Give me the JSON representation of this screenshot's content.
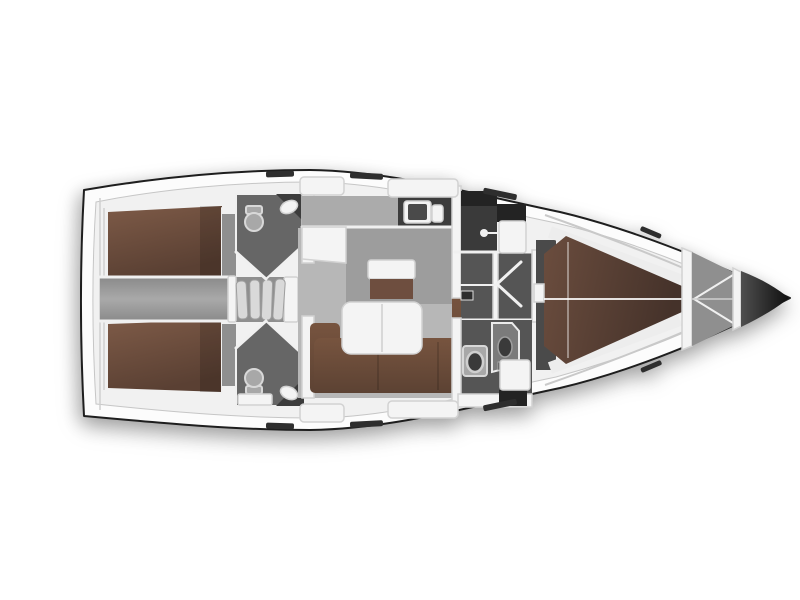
{
  "figure": {
    "kind": "sailing-yacht-interior-floor-plan",
    "view": "top-down, bow pointing right",
    "visible_text": []
  },
  "palette": {
    "page_bg": "#ffffff",
    "hull_line": "#1e1e1e",
    "hull_fill": "#fcfcfc",
    "deck_fill": "#f1f1f1",
    "deck_stroke": "#c6c6c6",
    "rim_line": "#cfcfcf",
    "floor_salon": "#b7b7b7",
    "floor_salon_dark": "#9d9d9d",
    "floor_cabin": "#8f8f8f",
    "corr_edge": "#8a8a8a",
    "corr_mid": "#a9a9a9",
    "floor_dark": "#4a4a4a",
    "wet_floor": "#555555",
    "wet_dark": "#3a3a3a",
    "wet_darkest": "#232323",
    "head_floor": "#666666",
    "counter_dark": "#3c3c3c",
    "counter_shadow": "#ababab",
    "bed_light": "#7d5a47",
    "bed_dark": "#5a4033",
    "fwd_bed_light": "#6b4d3e",
    "fwd_bed_dark": "#45322a",
    "sofa_light": "#77543f",
    "sofa_dark": "#5c4233",
    "wood_small": "#6e4e3f",
    "furn_white": "#f4f4f4",
    "furn_stroke": "#d2d2d2",
    "trim_white": "#f0f0f0",
    "step_fill": "#d9d9d9",
    "step_stroke": "#9e9e9e",
    "fixture_light": "#a8a8a8",
    "fixture_stroke": "#d8d8d8",
    "hatch_dark": "#2e2e2e",
    "tip_light": "#4f4f4f",
    "tip_dark": "#0f0f0f",
    "track_line": "#c9c9c9",
    "shadow_soft": "rgba(0,0,0,0.28)",
    "shadow_faint": "rgba(0,0,0,0.15)"
  },
  "rooms": [
    {
      "id": "aft-cabin-port",
      "name": "Aft double cabin (port)"
    },
    {
      "id": "aft-head-port",
      "name": "Aft head (port)"
    },
    {
      "id": "aft-passage",
      "name": "Aft passageway"
    },
    {
      "id": "companionway-steps",
      "name": "Companionway steps"
    },
    {
      "id": "aft-cabin-starboard",
      "name": "Aft double cabin (starboard)"
    },
    {
      "id": "aft-head-starboard",
      "name": "Aft head (starboard)"
    },
    {
      "id": "galley",
      "name": "Galley with twin sinks"
    },
    {
      "id": "salon",
      "name": "Salon with L-sofa and folding table"
    },
    {
      "id": "shower-room",
      "name": "Shower room"
    },
    {
      "id": "mid-passage",
      "name": "Midship passageway with doors"
    },
    {
      "id": "forward-head",
      "name": "Forward head with shower"
    },
    {
      "id": "forward-cabin",
      "name": "Forward V-berth cabin"
    },
    {
      "id": "bow",
      "name": "Bow anchor locker"
    }
  ]
}
